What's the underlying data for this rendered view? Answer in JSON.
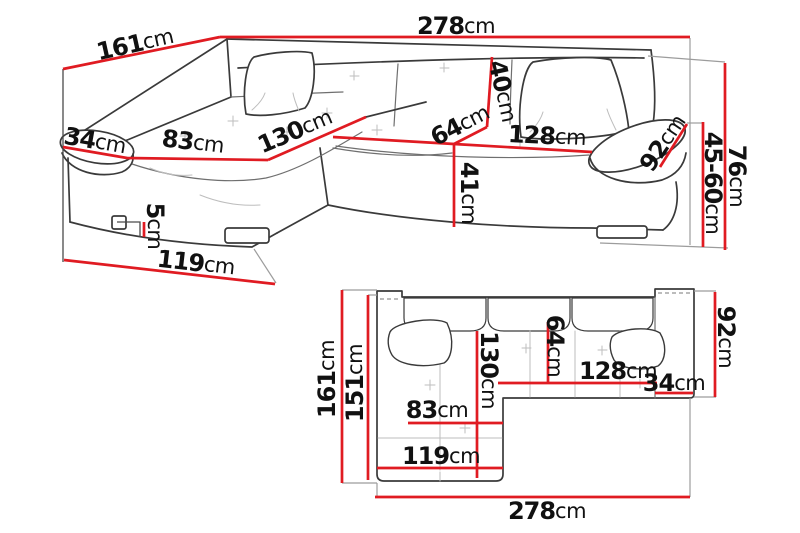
{
  "diagram": {
    "type": "sofa-dimensions",
    "views": [
      "perspective",
      "top-plan"
    ]
  },
  "colors": {
    "dimension_line": "#e01b22",
    "outline": "#3a3a3a",
    "extension_line": "#9c9c9c",
    "label_text": "#111111",
    "background": "#ffffff"
  },
  "dims": {
    "persp": {
      "w278": {
        "v": "278",
        "u": "cm"
      },
      "d161": {
        "v": "161",
        "u": "cm"
      },
      "a34": {
        "v": "34",
        "u": "cm"
      },
      "s83": {
        "v": "83",
        "u": "cm"
      },
      "s130": {
        "v": "130",
        "u": "cm"
      },
      "s64": {
        "v": "64",
        "u": "cm"
      },
      "b40": {
        "v": "40",
        "u": "cm"
      },
      "h41": {
        "v": "41",
        "u": "cm"
      },
      "s128": {
        "v": "128",
        "u": "cm"
      },
      "a92": {
        "v": "92",
        "u": "cm"
      },
      "h4560": {
        "v": "45-60",
        "u": "cm"
      },
      "h76": {
        "v": "76",
        "u": "cm"
      },
      "leg5": {
        "v": "5",
        "u": "cm"
      },
      "f119": {
        "v": "119",
        "u": "cm"
      }
    },
    "plan": {
      "d161": {
        "v": "161",
        "u": "cm"
      },
      "d151": {
        "v": "151",
        "u": "cm"
      },
      "s130": {
        "v": "130",
        "u": "cm"
      },
      "s64": {
        "v": "64",
        "u": "cm"
      },
      "s128": {
        "v": "128",
        "u": "cm"
      },
      "a34": {
        "v": "34",
        "u": "cm"
      },
      "d92": {
        "v": "92",
        "u": "cm"
      },
      "s83": {
        "v": "83",
        "u": "cm"
      },
      "f119": {
        "v": "119",
        "u": "cm"
      },
      "w278": {
        "v": "278",
        "u": "cm"
      }
    }
  }
}
